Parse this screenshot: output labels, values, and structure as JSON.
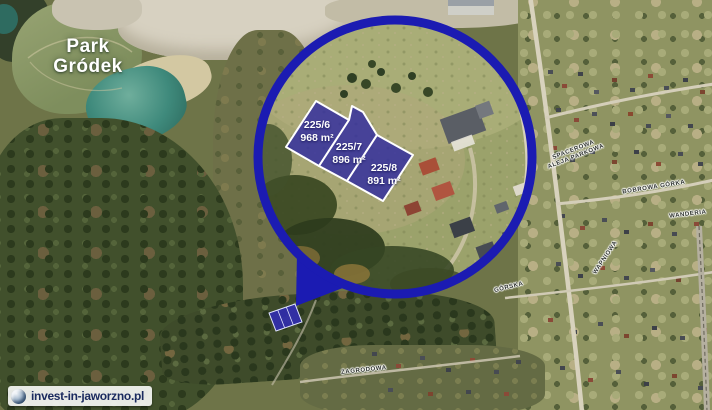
{
  "map": {
    "park_label": {
      "line1": "Park",
      "line2": "Gródek"
    },
    "parcels": [
      {
        "id": "225/6",
        "area": "968 m²"
      },
      {
        "id": "225/7",
        "area": "896 m²"
      },
      {
        "id": "225/8",
        "area": "891 m²"
      }
    ],
    "street_labels": [
      {
        "text": "SPACEROWA"
      },
      {
        "text": "ALEJA PARKOWA"
      },
      {
        "text": "BOBROWA GÓRKA"
      },
      {
        "text": "WANDERIA"
      },
      {
        "text": "WAPNIOWA"
      },
      {
        "text": "GÓRSKA"
      },
      {
        "text": "ZAGRODOWA"
      }
    ],
    "watermark": {
      "text": "invest-in-jaworzno.pl"
    },
    "colors": {
      "highlight_ring": "#1b1bb2",
      "parcel_fill": "#2d28a0",
      "parcel_border": "#ffffff",
      "lake": "#3f8a7c",
      "watermark_text": "#1a2a5e"
    }
  }
}
